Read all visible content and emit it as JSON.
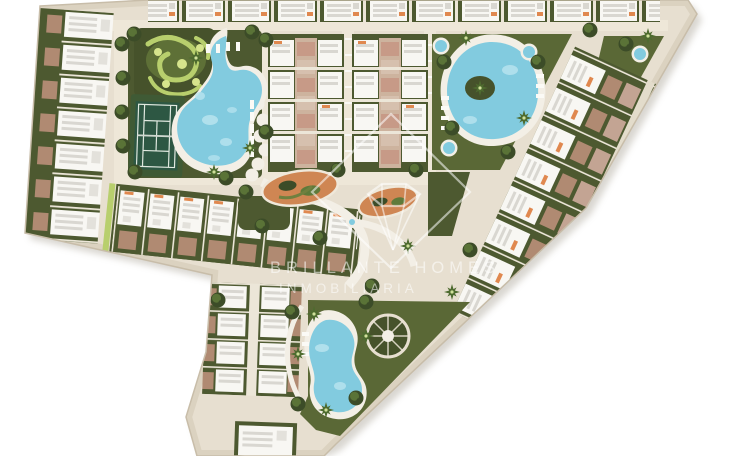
{
  "watermark": {
    "logo": "diamond-gem-icon",
    "line1": "BRILLANTE HOMES",
    "line2": "INMOBILIARIA"
  },
  "features": [
    "hedge-maze-garden",
    "tennis-court",
    "lagoon-pool",
    "oval-pool",
    "children-round-pools",
    "kidney-pool",
    "central-plaza-planters",
    "townhouse-rows",
    "apartment-blocks",
    "palm-trees",
    "sun-loungers"
  ],
  "palette": {
    "road_base": "#e7dfd0",
    "road_light": "#eee7d8",
    "walk": "#ece6d8",
    "edge_band": "#dbd2c0",
    "edge_line": "#c8bda9",
    "garden": "#4d5930",
    "garden_dark": "#46522b",
    "lawn": "#5a6836",
    "hedge_light": "#b8cf6d",
    "hedge_pale": "#d6e48c",
    "court_apron": "#3f5a35",
    "court_green": "#2d5743",
    "court_line": "#dfe8df",
    "pool": "#82cbdf",
    "pool_light": "#b9e4ef",
    "pool_deep": "#5cb6d2",
    "deck": "#f3efe6",
    "roof": "#f8f7f3",
    "roof_stripe": "#d9d7d1",
    "roof_unit": "#e3e1db",
    "terrace": "#b08a72",
    "terrace_mauve": "#c3a493",
    "orange": "#e0884f",
    "terracotta": "#cf8653",
    "tree": "#3c4c28",
    "tree_light": "#5f7a3a",
    "palm": "#4e6b2f",
    "watermark": "rgba(255,255,255,0.55)",
    "shadow": "#a09a8b"
  }
}
